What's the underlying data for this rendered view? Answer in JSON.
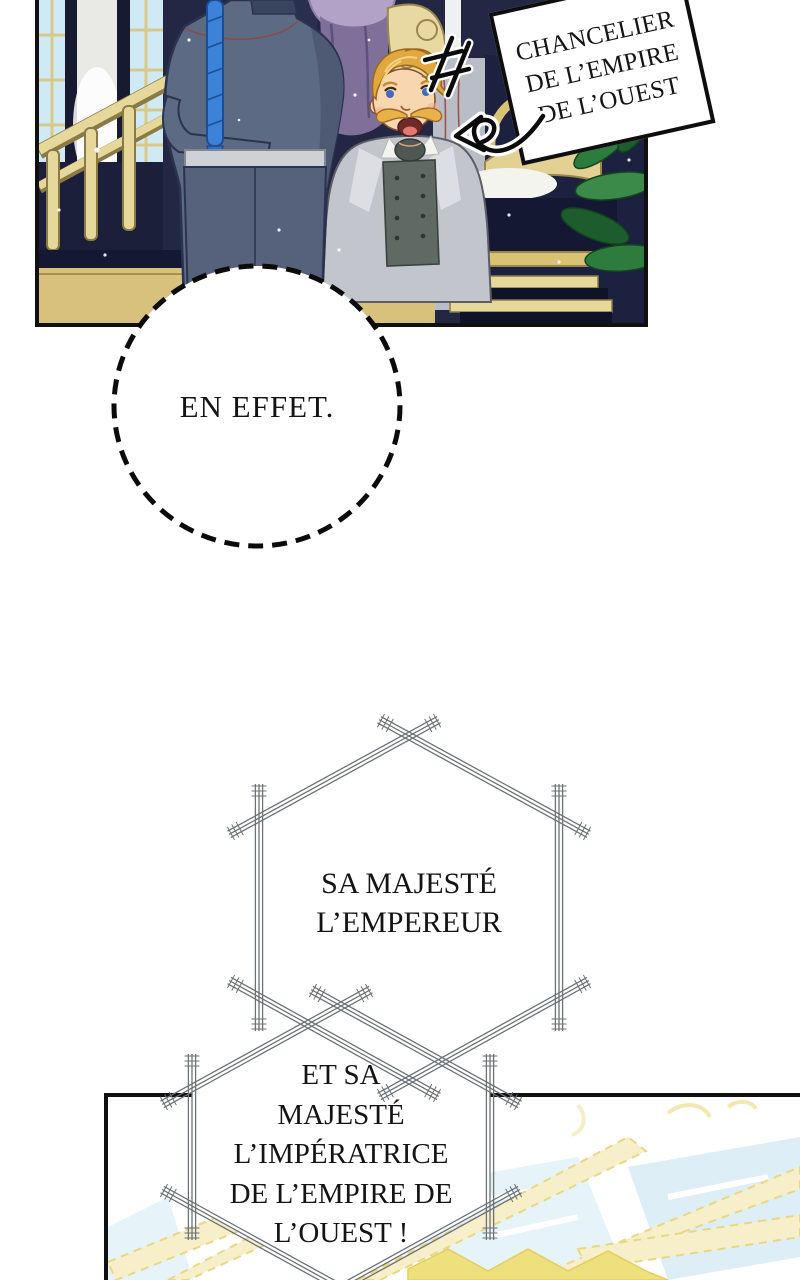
{
  "comic": {
    "caption_box": {
      "lines": [
        "CHANCELIER",
        "DE L’EMPIRE",
        "DE L’OUEST"
      ]
    },
    "speech_round": {
      "text": "EN EFFET."
    },
    "speech_hex_top": {
      "lines": [
        "SA MAJESTÉ",
        "L’EMPEREUR"
      ]
    },
    "speech_hex_bottom": {
      "lines": [
        "ET SA",
        "MAJESTÉ",
        "L’IMPÉRATRICE",
        "DE L’EMPIRE DE",
        "L’OUEST !"
      ]
    }
  },
  "colors": {
    "ink": "#101010",
    "hex_line": "#6b7278",
    "panel_navy": "#232743",
    "gold_trim": "#e6d79a",
    "uniform_blue": "#5d6a84",
    "braid_blue": "#3b82d8",
    "coat_grey": "#c2c5cc",
    "hair_gold": "#e2a840",
    "skin": "#f8d6b0",
    "window_blue": "#cfe9f5",
    "pale_glass": "#e4f2f8",
    "pale_beam": "#f6efca"
  }
}
